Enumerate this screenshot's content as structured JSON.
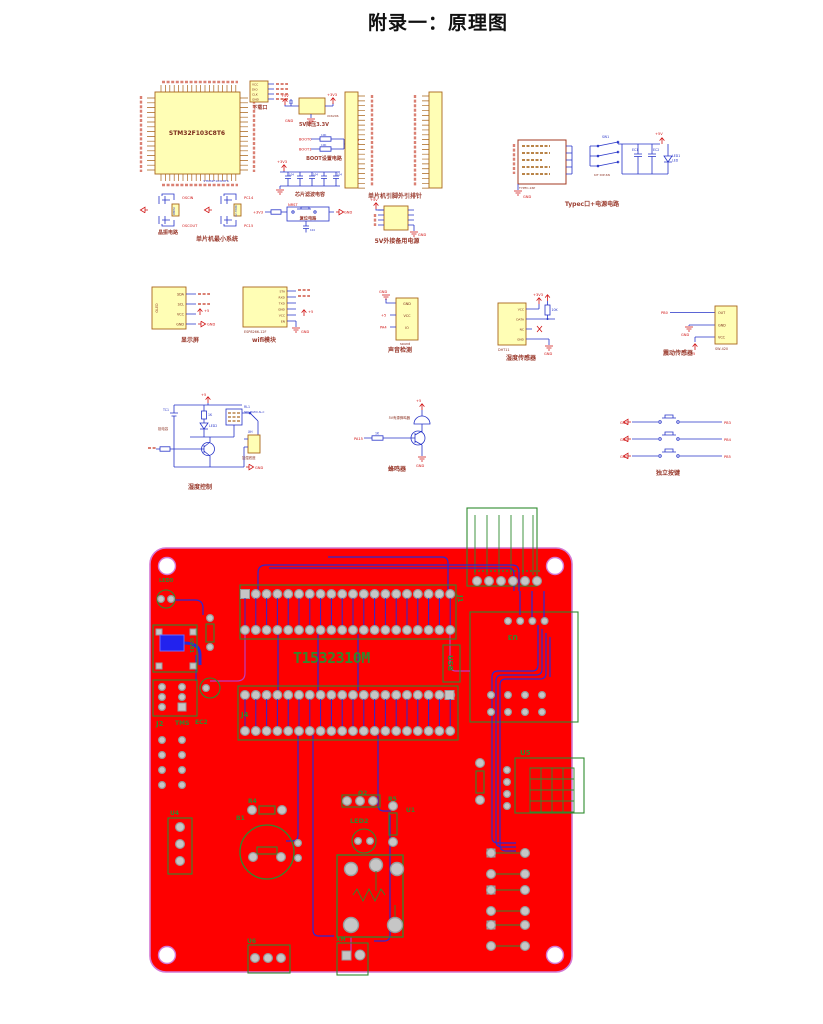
{
  "page": {
    "title": "附录一：原理图"
  },
  "colors": {
    "board_red": "#fe0000",
    "board_outline": "#d478d4",
    "silk_green": "#2e8b2e",
    "trace_blue": "#2b2bd4",
    "trace_magenta": "#be3bbe",
    "pad_gray": "#c6c6c6",
    "chip_yellow": "#fffeb5",
    "chip_border": "#a8651a",
    "wire_blue": "#2633c8",
    "net_red": "#d01313",
    "caption_maroon": "#9a3b2e"
  },
  "schematic": {
    "mcu": {
      "caption": "单片机最小系统",
      "chip": "STM32F103C8T6",
      "crystal_caption": "晶振电路",
      "y1": "8MHz",
      "y2": "32.768K",
      "oscin": "OSCIN",
      "oscout": "OSCOUT",
      "pc14": "PC14",
      "pc15": "PC15"
    },
    "download": {
      "caption": "下载口",
      "pins": [
        "VCC",
        "DIO",
        "CLK",
        "GND"
      ]
    },
    "regulator": {
      "caption": "5V降压3.3V",
      "chip": "XC6206",
      "vin": "+5V",
      "vout": "+3V3",
      "gnd": "GND",
      "cap": "104"
    },
    "boot": {
      "caption": "BOOT设置电路",
      "pins": [
        "BOOT0",
        "BOOT1"
      ],
      "r": "10K",
      "gnd": "GND"
    },
    "filter": {
      "caption": "芯片滤波电容",
      "net": "+3V3",
      "value": "104",
      "gnd": "GND"
    },
    "reset": {
      "caption": "复位电路",
      "net_l": "+3V3",
      "pin": "NRST",
      "net_r": "GND",
      "cap": "104"
    },
    "headers": {
      "caption": "单片机引脚外引排针"
    },
    "backup": {
      "caption": "5V外接备用电源",
      "v": "+5V",
      "gnd": "GND"
    },
    "typec": {
      "caption": "Typec口+电源电路",
      "conn": "TYPEC-16P",
      "sw": "SW1",
      "sw_part": "KIT DIP-6N",
      "cap1": "EC1",
      "cap2": "EC2",
      "led": "LED1",
      "led_sub": "LED",
      "v5": "+5V",
      "gnd": "GND"
    },
    "display": {
      "caption": "显示屏",
      "chip": "OLED",
      "pins": [
        "SDA",
        "SCL",
        "VCC",
        "GND"
      ],
      "v": "+5",
      "gnd": "GND"
    },
    "wifi": {
      "caption": "wifi模块",
      "chip": "ESP8266-12F",
      "pins": [
        "STA",
        "RXD",
        "TXD",
        "GND",
        "VCC",
        "EN"
      ],
      "v": "+5",
      "gnd": "GND"
    },
    "sound": {
      "caption": "声音检测",
      "chip": "sound",
      "pins": [
        "GND",
        "VCC",
        "IO"
      ],
      "net": "PA4",
      "v": "+5",
      "gnd": "GND"
    },
    "hsensor": {
      "caption": "湿度传感器",
      "chip": "DHT11",
      "pins": [
        "VCC",
        "DATA",
        "NC",
        "GND"
      ],
      "v": "+3V3",
      "r": "10K",
      "gnd": "GND"
    },
    "vib": {
      "caption": "震动传感器",
      "chip": "SW-420",
      "pins": [
        "OUT",
        "GND",
        "VCC"
      ],
      "net": "PB0",
      "v": "+5",
      "gnd": "GND"
    },
    "hctrl": {
      "caption": "湿度控制",
      "tc": "TC1",
      "tc_name": "钽电容",
      "led": "LED2",
      "r1": "1K",
      "relay": "RL1",
      "relay_part": "SRD-05VDC-SL-C",
      "sock": "XH",
      "sock_name": "加湿底座",
      "v5": "+5",
      "gnd": "GND"
    },
    "buzzer": {
      "caption": "蜂鸣器",
      "part": "5V有源蜂鸣器",
      "net": "PA15",
      "r": "1K",
      "v5": "+5",
      "gnd": "GND"
    },
    "keys": {
      "caption": "独立按键",
      "rows": [
        {
          "gnd": "GND",
          "net": "PB3"
        },
        {
          "gnd": "GND",
          "net": "PB4"
        },
        {
          "gnd": "GND",
          "net": "PB5"
        }
      ]
    }
  },
  "pcb": {
    "board_id": "T1532310M",
    "labels": {
      "usb": "USB",
      "j1": "J1",
      "j2": "J2",
      "j4": "J4",
      "tms": "TMS",
      "ec2": "EC2",
      "led0": "LED0",
      "usb1": "USB1",
      "u1": "U1",
      "u3": "U3",
      "u4": "U4",
      "u5": "U5",
      "u6": "U6",
      "xh": "XH",
      "r4": "R4",
      "r5": "R5",
      "b1": "B1",
      "q2": "Q2",
      "led2": "LED2"
    }
  }
}
